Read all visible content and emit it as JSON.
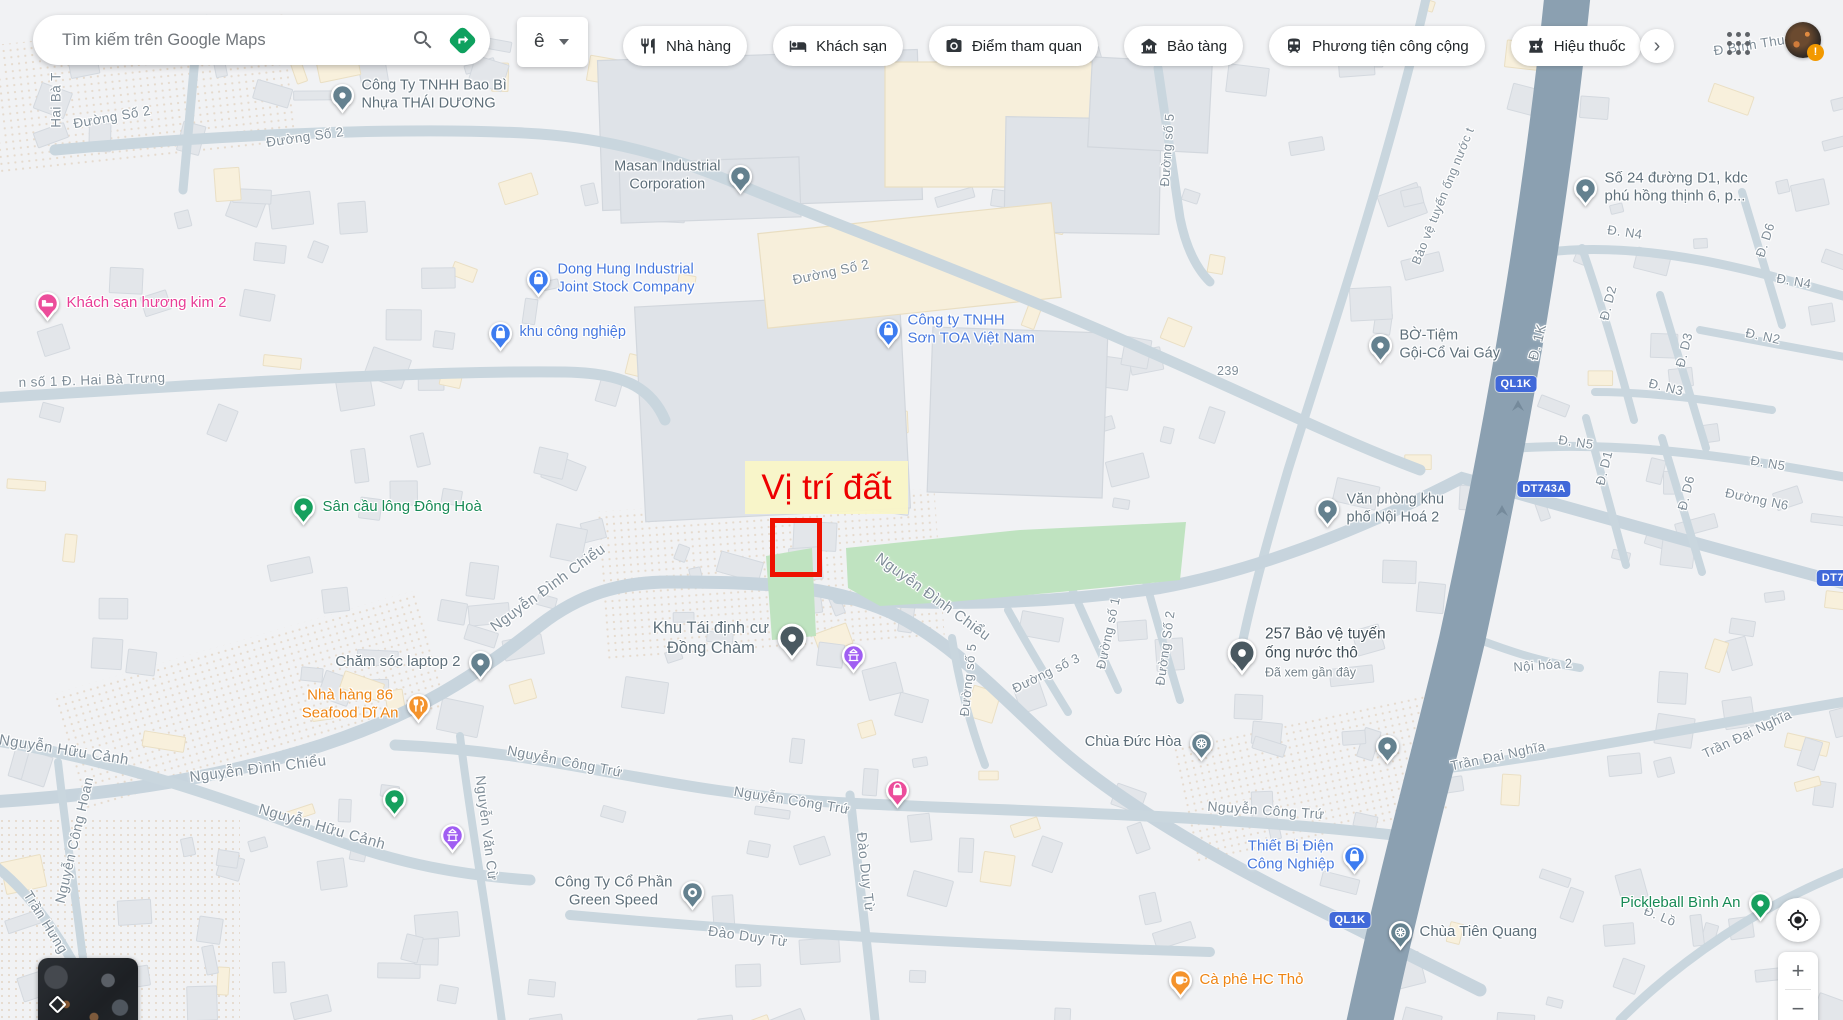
{
  "header": {
    "search_placeholder": "Tìm kiếm trên Google Maps",
    "ime_label": "ê",
    "more_label": "›",
    "avatar_badge": "!",
    "icons": {
      "search": "search-icon",
      "directions": "directions-icon",
      "ime_caret": "chevron-down-icon",
      "more": "chevron-right-icon",
      "apps": "apps-grid-icon",
      "my_location": "my-location-icon",
      "minimap_layers": "layers-diamond-icon"
    },
    "chips": [
      {
        "id": "restaurants",
        "label": "Nhà hàng",
        "icon": "restaurant-icon"
      },
      {
        "id": "hotels",
        "label": "Khách sạn",
        "icon": "hotel-icon"
      },
      {
        "id": "attractions",
        "label": "Điểm tham quan",
        "icon": "camera-icon"
      },
      {
        "id": "museums",
        "label": "Bảo tàng",
        "icon": "museum-icon"
      },
      {
        "id": "transit",
        "label": "Phương tiện công cộng",
        "icon": "transit-icon"
      },
      {
        "id": "pharmacies",
        "label": "Hiệu thuốc",
        "icon": "pharmacy-icon"
      }
    ]
  },
  "controls": {
    "zoom_in": "+",
    "zoom_out": "−"
  },
  "map": {
    "annotation": {
      "label": "Vị trí đất"
    },
    "shields": [
      {
        "t": "QL1K",
        "x": 1516,
        "y": 384
      },
      {
        "t": "DT743A",
        "x": 1544,
        "y": 489
      },
      {
        "t": "QL1K",
        "x": 1350,
        "y": 920
      },
      {
        "t": "DT74",
        "x": 1836,
        "y": 578
      }
    ],
    "street_labels": [
      {
        "t": "Hai Bà T",
        "x": 56,
        "y": 100,
        "r": -90,
        "s": 13.5
      },
      {
        "t": "Đường Số 2",
        "x": 112,
        "y": 117,
        "r": -10,
        "s": 13.5
      },
      {
        "t": "Đường Số 2",
        "x": 305,
        "y": 137,
        "r": -8,
        "s": 13.5
      },
      {
        "t": "Đường Số 2",
        "x": 831,
        "y": 272,
        "r": -12,
        "s": 13.5
      },
      {
        "t": "Đường số 5",
        "x": 1167,
        "y": 150,
        "r": -86,
        "s": 13
      },
      {
        "t": "n số 1 Đ. Hai Bà Trưng",
        "x": 92,
        "y": 380,
        "r": -2,
        "s": 13.5
      },
      {
        "t": "Đ Bình Thung",
        "x": 1757,
        "y": 44,
        "r": -9,
        "s": 13.5
      },
      {
        "t": "Bảo vệ tuyến ống nước t",
        "x": 1443,
        "y": 196,
        "r": -68,
        "s": 12.5
      },
      {
        "t": "Đ. 1K",
        "x": 1537,
        "y": 342,
        "r": -76,
        "s": 14
      },
      {
        "t": "Đ. N4",
        "x": 1625,
        "y": 232,
        "r": 8,
        "s": 13
      },
      {
        "t": "Đ. D6",
        "x": 1765,
        "y": 240,
        "r": -72,
        "s": 13
      },
      {
        "t": "Đ. N4",
        "x": 1794,
        "y": 281,
        "r": 10,
        "s": 13
      },
      {
        "t": "Đ. D2",
        "x": 1608,
        "y": 303,
        "r": -76,
        "s": 13
      },
      {
        "t": "Đ. N2",
        "x": 1763,
        "y": 336,
        "r": 12,
        "s": 13
      },
      {
        "t": "Đ. D3",
        "x": 1684,
        "y": 350,
        "r": -76,
        "s": 13
      },
      {
        "t": "Đ. N3",
        "x": 1666,
        "y": 387,
        "r": 14,
        "s": 13
      },
      {
        "t": "Đ. N5",
        "x": 1576,
        "y": 442,
        "r": 8,
        "s": 13
      },
      {
        "t": "Đ. D1",
        "x": 1604,
        "y": 468,
        "r": -76,
        "s": 13
      },
      {
        "t": "Đ. D6",
        "x": 1686,
        "y": 493,
        "r": -76,
        "s": 13
      },
      {
        "t": "Đ. N5",
        "x": 1768,
        "y": 463,
        "r": 10,
        "s": 13
      },
      {
        "t": "Đường N6",
        "x": 1757,
        "y": 499,
        "r": 12,
        "s": 13
      },
      {
        "t": "239",
        "x": 1228,
        "y": 371,
        "r": 0,
        "s": 12.5
      },
      {
        "t": "Nội hóa 2",
        "x": 1543,
        "y": 665,
        "r": -4,
        "s": 13
      },
      {
        "t": "Trần Đại Nghĩa",
        "x": 1498,
        "y": 756,
        "r": -12,
        "s": 13.5
      },
      {
        "t": "Trần Đại Nghĩa",
        "x": 1747,
        "y": 734,
        "r": -25,
        "s": 13.5
      },
      {
        "t": "Nguyễn Đình Chiểu",
        "x": 933,
        "y": 597,
        "r": 36,
        "s": 15
      },
      {
        "t": "Nguyễn Đình Chiểu",
        "x": 548,
        "y": 588,
        "r": -36,
        "s": 15
      },
      {
        "t": "Nguyễn Đình Chiểu",
        "x": 258,
        "y": 769,
        "r": -7,
        "s": 15
      },
      {
        "t": "Nguyễn Hữu Cảnh",
        "x": 64,
        "y": 750,
        "r": 9,
        "s": 15
      },
      {
        "t": "Nguyễn Hữu Cảnh",
        "x": 322,
        "y": 827,
        "r": 16,
        "s": 15
      },
      {
        "t": "Nguyễn Công Hoan",
        "x": 74,
        "y": 840,
        "r": -77,
        "s": 14
      },
      {
        "t": "Nguyễn Công Trứ",
        "x": 565,
        "y": 761,
        "r": 11,
        "s": 14
      },
      {
        "t": "Nguyễn Công Trứ",
        "x": 792,
        "y": 800,
        "r": 9,
        "s": 14
      },
      {
        "t": "Nguyễn Công Trứ",
        "x": 1266,
        "y": 810,
        "r": 4,
        "s": 14
      },
      {
        "t": "Đào Duy Từ",
        "x": 748,
        "y": 936,
        "r": 8,
        "s": 14
      },
      {
        "t": "Đào Duy Từ",
        "x": 866,
        "y": 872,
        "r": 84,
        "s": 14
      },
      {
        "t": "Trần Hưng",
        "x": 46,
        "y": 922,
        "r": 58,
        "s": 14
      },
      {
        "t": "Nguyễn Văn Cừ",
        "x": 487,
        "y": 828,
        "r": 83,
        "s": 14
      },
      {
        "t": "Đường số 3",
        "x": 1046,
        "y": 673,
        "r": -26,
        "s": 13
      },
      {
        "t": "Đường số 1",
        "x": 1108,
        "y": 633,
        "r": -78,
        "s": 13
      },
      {
        "t": "Đường Số 2",
        "x": 1165,
        "y": 648,
        "r": -82,
        "s": 13
      },
      {
        "t": "Đường số 5",
        "x": 968,
        "y": 680,
        "r": -84,
        "s": 13
      },
      {
        "t": "Đ. Lồ",
        "x": 1660,
        "y": 916,
        "r": 22,
        "s": 13
      }
    ],
    "pois": [
      {
        "id": "bao-bi-thai-duong",
        "lines": [
          "Công Ty TNHH Bao Bì",
          "Nhựa THÁI DƯƠNG"
        ],
        "tc": "gray",
        "pc": "pin_gray",
        "glyph": "dot",
        "x": 342,
        "y": 95,
        "side": "right",
        "align": "left",
        "fs": 14.5
      },
      {
        "id": "masan",
        "lines": [
          "Masan Industrial",
          "Corporation"
        ],
        "tc": "gray",
        "pc": "pin_gray",
        "glyph": "dot",
        "x": 740,
        "y": 176,
        "side": "left",
        "align": "center",
        "fs": 14.5
      },
      {
        "id": "dong-hung",
        "lines": [
          "Dong Hung Industrial",
          "Joint Stock Company"
        ],
        "tc": "blue",
        "pc": "pin_blue",
        "glyph": "bag",
        "x": 538,
        "y": 279,
        "side": "right",
        "align": "left",
        "fs": 14.5
      },
      {
        "id": "khu-cong-nghiep",
        "lines": [
          "khu công nghiệp"
        ],
        "tc": "blue",
        "pc": "pin_blue",
        "glyph": "bag",
        "x": 500,
        "y": 333,
        "side": "right",
        "align": "left",
        "fs": 14.5
      },
      {
        "id": "son-toa",
        "lines": [
          "Công ty TNHH",
          "Sơn TOA Việt Nam"
        ],
        "tc": "blue",
        "pc": "pin_blue",
        "glyph": "bag",
        "x": 888,
        "y": 330,
        "side": "right",
        "align": "left",
        "fs": 15
      },
      {
        "id": "khach-san-huong-kim",
        "lines": [
          "Khách sạn hương kim 2"
        ],
        "tc": "pink",
        "pc": "pin_pink",
        "glyph": "bed",
        "x": 47,
        "y": 303,
        "side": "right",
        "align": "left",
        "fs": 15
      },
      {
        "id": "san-cau-long-dong-hoa",
        "lines": [
          "Sân cầu lông Đông Hoà"
        ],
        "tc": "green",
        "pc": "pin_green",
        "glyph": "dot",
        "x": 303,
        "y": 507,
        "side": "right",
        "align": "left",
        "fs": 15
      },
      {
        "id": "cham-soc-laptop",
        "lines": [
          "Chăm sóc laptop 2"
        ],
        "tc": "gray",
        "pc": "pin_gray",
        "glyph": "dot",
        "x": 480,
        "y": 662,
        "side": "left",
        "align": "right",
        "fs": 15
      },
      {
        "id": "nha-hang-86",
        "lines": [
          "Nhà hàng 86",
          "Seafood Dĩ An"
        ],
        "tc": "orange",
        "pc": "pin_orange",
        "glyph": "fork",
        "x": 418,
        "y": 705,
        "side": "left",
        "align": "center",
        "fs": 15
      },
      {
        "id": "khu-tai-dinh-cu-dong-cham",
        "lines": [
          "Khu Tái định cư",
          "Đồng Chàm"
        ],
        "tc": "gray",
        "pc": "pin_dark",
        "glyph": "dot",
        "x": 792,
        "y": 638,
        "side": "left",
        "align": "center",
        "fs": 16.5,
        "big": true
      },
      {
        "id": "so-24-duong-d1",
        "lines": [
          "Số 24 đường D1, kdc",
          "phú hồng thịnh 6, p..."
        ],
        "tc": "gray",
        "pc": "pin_gray",
        "glyph": "dot",
        "x": 1585,
        "y": 188,
        "side": "right",
        "align": "left",
        "fs": 15
      },
      {
        "id": "bo-tiem-goi-co",
        "lines": [
          "BỜ-Tiệm",
          "Gội-Cổ Vai Gáy"
        ],
        "tc": "gray",
        "pc": "pin_gray",
        "glyph": "dot",
        "x": 1380,
        "y": 345,
        "side": "right",
        "align": "left",
        "fs": 14.5
      },
      {
        "id": "van-phong-noi-hoa-2",
        "lines": [
          "Văn phòng khu",
          "phố Nội Hoá 2"
        ],
        "tc": "gray",
        "pc": "pin_gray",
        "glyph": "dot",
        "x": 1327,
        "y": 509,
        "side": "right",
        "align": "left",
        "fs": 14.5
      },
      {
        "id": "257-bao-ve-tuyen-ong",
        "lines": [
          "257 Bảo vệ tuyến",
          "ống nước thô"
        ],
        "sub": "Đã xem gần đây",
        "tc": "dark",
        "pc": "pin_dark",
        "glyph": "dot",
        "x": 1242,
        "y": 653,
        "side": "right",
        "align": "left",
        "fs": 15.5,
        "big": true
      },
      {
        "id": "chua-duc-hoa",
        "lines": [
          "Chùa Đức Hòa"
        ],
        "tc": "gray",
        "pc": "pin_gray",
        "glyph": "wheel",
        "x": 1201,
        "y": 743,
        "side": "left",
        "align": "right",
        "fs": 14.5
      },
      {
        "id": "thiet-bi-dien-cong-nghiep",
        "lines": [
          "Thiết Bị Điện",
          "Công Nghiệp"
        ],
        "tc": "blue",
        "pc": "pin_blue",
        "glyph": "bag",
        "x": 1354,
        "y": 856,
        "side": "left",
        "align": "center",
        "fs": 15
      },
      {
        "id": "chua-tien-quang",
        "lines": [
          "Chùa Tiên Quang"
        ],
        "tc": "gray",
        "pc": "pin_gray",
        "glyph": "wheel",
        "x": 1400,
        "y": 932,
        "side": "right",
        "align": "left",
        "fs": 15
      },
      {
        "id": "pickleball-binh-an",
        "lines": [
          "Pickleball Bình An"
        ],
        "tc": "green",
        "pc": "pin_green",
        "glyph": "dot",
        "x": 1760,
        "y": 903,
        "side": "left",
        "align": "right",
        "fs": 15
      },
      {
        "id": "ca-phe-hc-tho",
        "lines": [
          "Cà phê HC Thỏ"
        ],
        "tc": "orange",
        "pc": "pin_orange",
        "glyph": "cafe",
        "x": 1180,
        "y": 980,
        "side": "right",
        "align": "left",
        "fs": 15
      },
      {
        "id": "green-speed",
        "lines": [
          "Công Ty Cổ Phần",
          "Green Speed"
        ],
        "tc": "gray",
        "pc": "pin_gray",
        "glyph": "ring",
        "x": 692,
        "y": 892,
        "side": "left",
        "align": "center",
        "fs": 15
      },
      {
        "id": "worship-marker-1",
        "lines": [],
        "pc": "pin_purple",
        "glyph": "worship",
        "x": 853,
        "y": 655
      },
      {
        "id": "worship-marker-2",
        "lines": [],
        "pc": "pin_purple",
        "glyph": "worship",
        "x": 452,
        "y": 835
      },
      {
        "id": "green-marker",
        "lines": [],
        "pc": "pin_green",
        "glyph": "dot",
        "x": 394,
        "y": 799
      },
      {
        "id": "pink-marker",
        "lines": [],
        "pc": "pin_pink",
        "glyph": "bag",
        "x": 897,
        "y": 790
      },
      {
        "id": "gray-marker",
        "lines": [],
        "pc": "pin_gray",
        "glyph": "dot",
        "x": 1387,
        "y": 746
      }
    ]
  },
  "palette": {
    "street": "#7f8d98",
    "gray": "#5e6f7a",
    "dark": "#414f58",
    "sub": "#74828b",
    "blue": "#4577df",
    "orange": "#ee8412",
    "green": "#178a55",
    "pink": "#e83d96",
    "shield_bg": "#4169d9",
    "annotation_text": "#ee0000",
    "annotation_bg": "#f8f4c9",
    "red_rect": "#ee1100",
    "highway": "#8ba0b1",
    "road": "#c9d6de",
    "park": "#bfe3c0",
    "pin_gray": "#64818f",
    "pin_dark": "#4a5961",
    "pin_blue": "#3d7cf0",
    "pin_orange": "#f4932c",
    "pin_green": "#16a05e",
    "pin_pink": "#ec4d9b",
    "pin_purple": "#a05ef2",
    "directions_green": "#0fa15f"
  }
}
